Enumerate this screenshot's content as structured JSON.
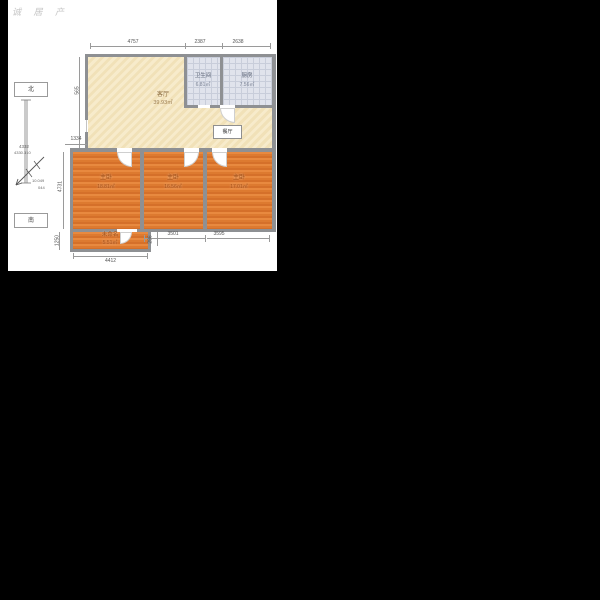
{
  "watermark": "诚 居 产",
  "compass": {
    "north_label": "北",
    "south_label": "南",
    "scale_text_1": "4332",
    "scale_text_2": "4330.310",
    "bearing_text_1": "10.049",
    "bearing_text_2": "044"
  },
  "rooms": {
    "living": {
      "name": "客厅",
      "area": "39.93㎡"
    },
    "bathroom": {
      "name": "卫生间",
      "area": "6.81㎡"
    },
    "kitchen": {
      "name": "厨房",
      "area": "7.56㎡"
    },
    "dining": {
      "name": "餐厅"
    },
    "bedroom1": {
      "name": "主卧",
      "area": "18.81㎡"
    },
    "bedroom2": {
      "name": "主卧",
      "area": "16.56㎡"
    },
    "bedroom3": {
      "name": "主卧",
      "area": "17.01㎡"
    },
    "unnamed": {
      "name": "未命名",
      "area": "5.51㎡"
    }
  },
  "dimensions": {
    "top": [
      "4757",
      "2387",
      "2638"
    ],
    "left_565": "565",
    "left_1334": "1334",
    "left_4731": "4731",
    "left_1250": "1250",
    "bottom_4412": "4412",
    "bottom_296": "296",
    "bottom_3501": "3501",
    "bottom_3595": "3595"
  },
  "colors": {
    "background": "#000000",
    "canvas": "#ffffff",
    "wall": "#8e9093",
    "living_floor": "#f5e8c6",
    "bedroom_floor": "#df7c33",
    "tile_floor": "#e0e3ec",
    "dimension_text": "#555555"
  }
}
